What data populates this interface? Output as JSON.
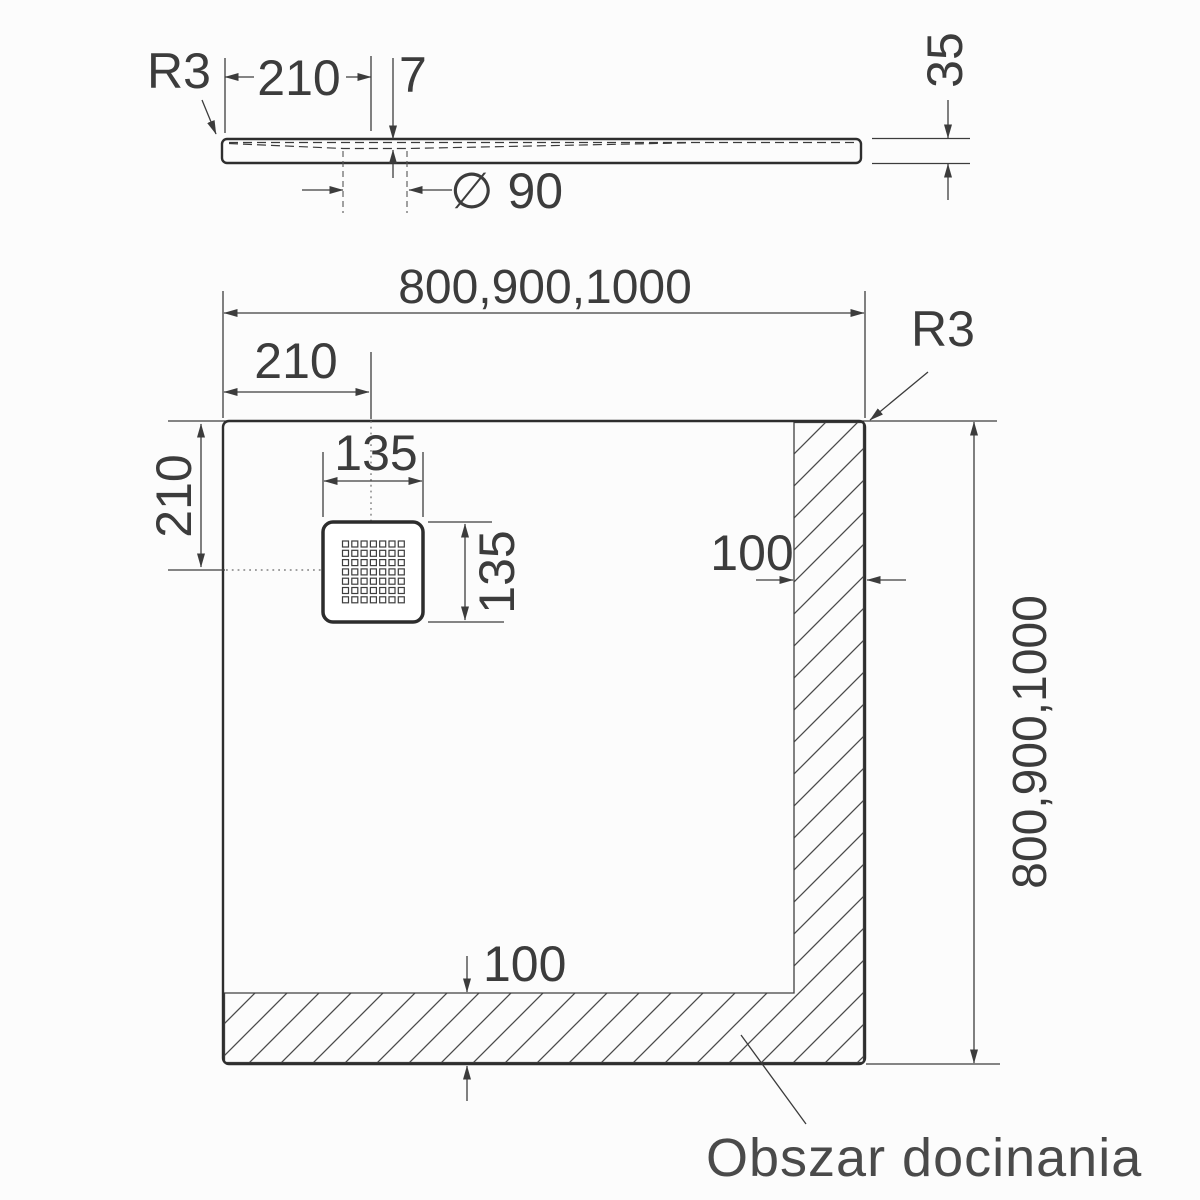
{
  "side_view": {
    "radius_label": "R3",
    "dim_210": "210",
    "dim_7": "7",
    "dim_drain_diameter": "∅ 90",
    "dim_35": "35"
  },
  "plan_view": {
    "dim_width": "800,900,1000",
    "dim_length": "800,900,1000",
    "radius_label": "R3",
    "dim_210_top": "210",
    "dim_210_left": "210",
    "dim_135_width": "135",
    "dim_135_height": "135",
    "dim_100_right": "100",
    "dim_100_bottom": "100",
    "trim_area_label": "Obszar docinania",
    "drain": {
      "grid_rows": 7,
      "grid_cols": 7
    }
  }
}
